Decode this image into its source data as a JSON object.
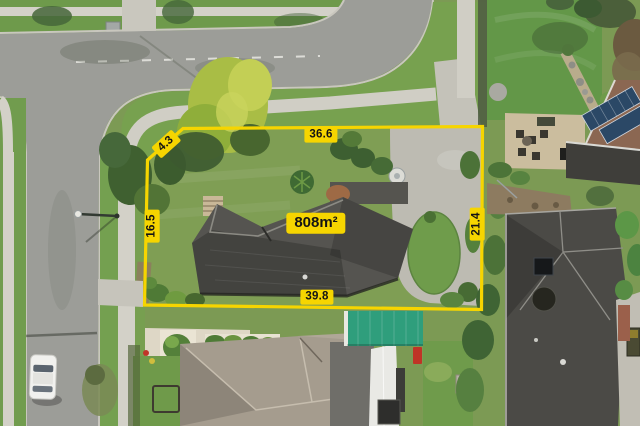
{
  "overlay": {
    "area_label": "808m²",
    "measurements": [
      {
        "side": "top",
        "value": "36.6"
      },
      {
        "side": "top-left-diagonal",
        "value": "4.3"
      },
      {
        "side": "left",
        "value": "16.5"
      },
      {
        "side": "right",
        "value": "21.4"
      },
      {
        "side": "bottom",
        "value": "39.8"
      }
    ],
    "colors": {
      "boundary": "#F6D500",
      "label_bg": "#F6D500",
      "label_text": "#141414"
    }
  },
  "scene": {
    "palette": {
      "road": "#9C9D98",
      "footpath": "#D3D1C8",
      "grass": "#7C9A54",
      "subject_roof": "#55544E",
      "driveway_concrete": "#BDBBB2",
      "teal_garage_roof": "#2F9E7C",
      "solar_panels": "#2B4866",
      "south_neighbor_roof": "#A59C8E"
    }
  }
}
